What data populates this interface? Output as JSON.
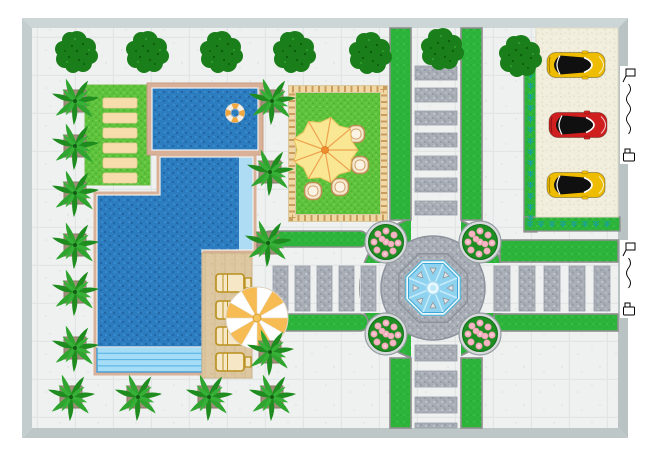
{
  "app": {
    "name": "landscape-garden-plan-canvas"
  },
  "canvas": {
    "width": 650,
    "height": 460,
    "background": "#ffffff"
  },
  "colors": {
    "pavement": "#eff1f1",
    "pavement_grid": "#e1e5e6",
    "wall_top": "#ccd6d6",
    "wall_left": "#c3cdcd",
    "wall_right": "#b9c3c3",
    "wall_bottom": "#bdc7c7",
    "grass": "#5ec23d",
    "road_green": "#2db53b",
    "curb": "#8f8f8f",
    "gravel": "#a9aeb6",
    "water": "#2c7cc0",
    "water_pale": "#aedcf4",
    "steps_fill": "#a5dcf6",
    "steps_line": "#3b97d3",
    "pool_tile": "#d8b198",
    "deck": "#dcc7a0",
    "parking_sand": "#f1eedd",
    "fence_tan": "#f0d7a4",
    "fence_dash": "#c89d5e",
    "bush_green": "#1a7e1a",
    "palm_green": "#1f8c1f",
    "planter": "#a08d7a",
    "bed_green": "#1d8f22",
    "flower_pink": "#f5b5c2",
    "parasol_yellow": "#f9e794",
    "parasol_rib": "#efa34f",
    "beach_umbrella_white": "#ffffff",
    "beach_umbrella_orange": "#f6bc53",
    "sunbed_tan": "#f7ddab",
    "lounger_gold": "#b9901e",
    "car_yellow": "#eebc00",
    "car_red": "#cf1f1f",
    "fountain_water": "#8fd2ef",
    "sprig_teal": "#17a0a0"
  },
  "site": {
    "wall": {
      "x": 22,
      "y": 18,
      "w": 606,
      "h": 420,
      "thickness": 10
    }
  },
  "bushes": [
    {
      "x": 77,
      "y": 52
    },
    {
      "x": 148,
      "y": 52
    },
    {
      "x": 222,
      "y": 52
    },
    {
      "x": 295,
      "y": 52
    },
    {
      "x": 371,
      "y": 53
    },
    {
      "x": 443,
      "y": 49
    },
    {
      "x": 521,
      "y": 56
    }
  ],
  "palms": [
    {
      "x": 75,
      "y": 101
    },
    {
      "x": 75,
      "y": 146
    },
    {
      "x": 75,
      "y": 193
    },
    {
      "x": 75,
      "y": 245
    },
    {
      "x": 75,
      "y": 292
    },
    {
      "x": 75,
      "y": 348
    },
    {
      "x": 71,
      "y": 397
    },
    {
      "x": 138,
      "y": 397
    },
    {
      "x": 209,
      "y": 397
    },
    {
      "x": 272,
      "y": 397
    },
    {
      "x": 272,
      "y": 101
    },
    {
      "x": 270,
      "y": 172
    },
    {
      "x": 268,
      "y": 243
    },
    {
      "x": 270,
      "y": 352
    }
  ],
  "lawn": {
    "x": 85,
    "y": 85,
    "w": 65,
    "h": 100,
    "sunbeds": {
      "x": 103,
      "w": 34,
      "h": 10,
      "ys": [
        98,
        113,
        128,
        143,
        158,
        173
      ]
    }
  },
  "garden": {
    "x": 288,
    "y": 85,
    "w": 100,
    "h": 137,
    "parasol": {
      "cx": 325,
      "cy": 150
    },
    "chairs": [
      {
        "x": 356,
        "y": 134
      },
      {
        "x": 360,
        "y": 165
      },
      {
        "x": 340,
        "y": 187
      },
      {
        "x": 313,
        "y": 191
      }
    ]
  },
  "pools": {
    "top_pool": {
      "x": 152,
      "y": 88,
      "w": 106,
      "h": 62,
      "lifebuoy": {
        "cx": 235,
        "cy": 113
      }
    },
    "main_pool_outline": "M160,157 H253 V250 H202 V372 H97 V195 H160 Z",
    "main_pool_water": "M160,157 H253 V250 H202 V347 H97 V195 H160 Z",
    "pale_strip": {
      "x": 239,
      "y": 157,
      "w": 14,
      "h": 93
    },
    "steps": {
      "x": 97,
      "y": 347,
      "w": 105,
      "h": 25,
      "line_ys": [
        353.3,
        359.6,
        365.9
      ]
    }
  },
  "deck": {
    "x": 202,
    "y": 253,
    "w": 50,
    "h": 125,
    "loungers": {
      "x": 233,
      "ys": [
        283,
        310,
        336,
        362
      ]
    },
    "umbrella": {
      "cx": 257,
      "cy": 318,
      "r": 31,
      "wedges": 12
    }
  },
  "roads": {
    "junction": {
      "cx": 433,
      "cy": 288,
      "green_r": 73,
      "plaza_r": 52
    },
    "bands": [
      {
        "x": 411,
        "y": 213,
        "w": 50,
        "h": 150
      },
      {
        "x": 360,
        "y": 263,
        "w": 150,
        "h": 50
      }
    ],
    "greens": [
      {
        "x": 390,
        "y": 28,
        "w": 21,
        "h": 192,
        "rx": 0
      },
      {
        "x": 461,
        "y": 28,
        "w": 21,
        "h": 192,
        "rx": 0
      },
      {
        "x": 390,
        "y": 358,
        "w": 21,
        "h": 70,
        "rx": 0
      },
      {
        "x": 461,
        "y": 358,
        "w": 21,
        "h": 70,
        "rx": 0
      },
      {
        "x": 262,
        "y": 231,
        "w": 106,
        "h": 16,
        "rx": 8
      },
      {
        "x": 274,
        "y": 314,
        "w": 94,
        "h": 17,
        "rx": 8
      },
      {
        "x": 500,
        "y": 240,
        "w": 118,
        "h": 22,
        "rx": 0
      },
      {
        "x": 494,
        "y": 314,
        "w": 124,
        "h": 17,
        "rx": 0
      }
    ],
    "crosswalks": {
      "north": {
        "x": 415,
        "w": 42,
        "h": 14,
        "ys": [
          66,
          88,
          111,
          133,
          156,
          178,
          201
        ]
      },
      "south": {
        "x": 415,
        "w": 42,
        "stripes": [
          {
            "y": 345,
            "h": 16
          },
          {
            "y": 371,
            "h": 16
          },
          {
            "y": 397,
            "h": 16
          },
          {
            "y": 423,
            "h": 5
          }
        ]
      },
      "west": {
        "y": 266,
        "h": 45,
        "w": 15,
        "xs": [
          273,
          295,
          317,
          339,
          361
        ]
      },
      "east": {
        "y": 266,
        "h": 45,
        "w": 16,
        "xs": [
          494,
          519,
          544,
          569,
          594
        ]
      }
    }
  },
  "flower_beds": [
    {
      "x": 386,
      "y": 242
    },
    {
      "x": 480,
      "y": 242
    },
    {
      "x": 386,
      "y": 334
    },
    {
      "x": 480,
      "y": 334
    }
  ],
  "fountain": {
    "cx": 433,
    "cy": 288,
    "outer_r": 37,
    "ring_r": 29.5,
    "water_r": 26.5,
    "rib_angles": [
      22.5,
      67.5,
      112.5,
      157.5,
      202.5,
      247.5,
      292.5,
      337.5
    ],
    "tri_angles": [
      0,
      45,
      90,
      135,
      180,
      225,
      270,
      315
    ],
    "tri_r": 17.5
  },
  "hedges": {
    "vertical": {
      "x": 524,
      "y": 56,
      "w": 13,
      "h": 176,
      "sprig_x": 530.5,
      "sprig_from": 64,
      "sprig_to": 228,
      "step": 11
    },
    "horizontal": {
      "x": 524,
      "y": 217,
      "w": 96,
      "h": 14,
      "sprig_y": 224,
      "sprig_from": 530,
      "sprig_to": 616,
      "step": 11
    }
  },
  "parking": {
    "x": 536,
    "y": 28,
    "w": 82,
    "h": 189,
    "cars": [
      {
        "x": 576,
        "y": 65,
        "fill": "#eebc00",
        "name": "yellow-sports-car"
      },
      {
        "x": 578,
        "y": 125,
        "fill": "#cf1f1f",
        "name": "red-sports-car"
      },
      {
        "x": 576,
        "y": 185,
        "fill": "#eebc00",
        "name": "yellow-sports-car"
      }
    ]
  },
  "handles": [
    {
      "x": 620,
      "y": 66,
      "w": 19,
      "h": 98
    },
    {
      "x": 620,
      "y": 240,
      "w": 19,
      "h": 78
    }
  ]
}
